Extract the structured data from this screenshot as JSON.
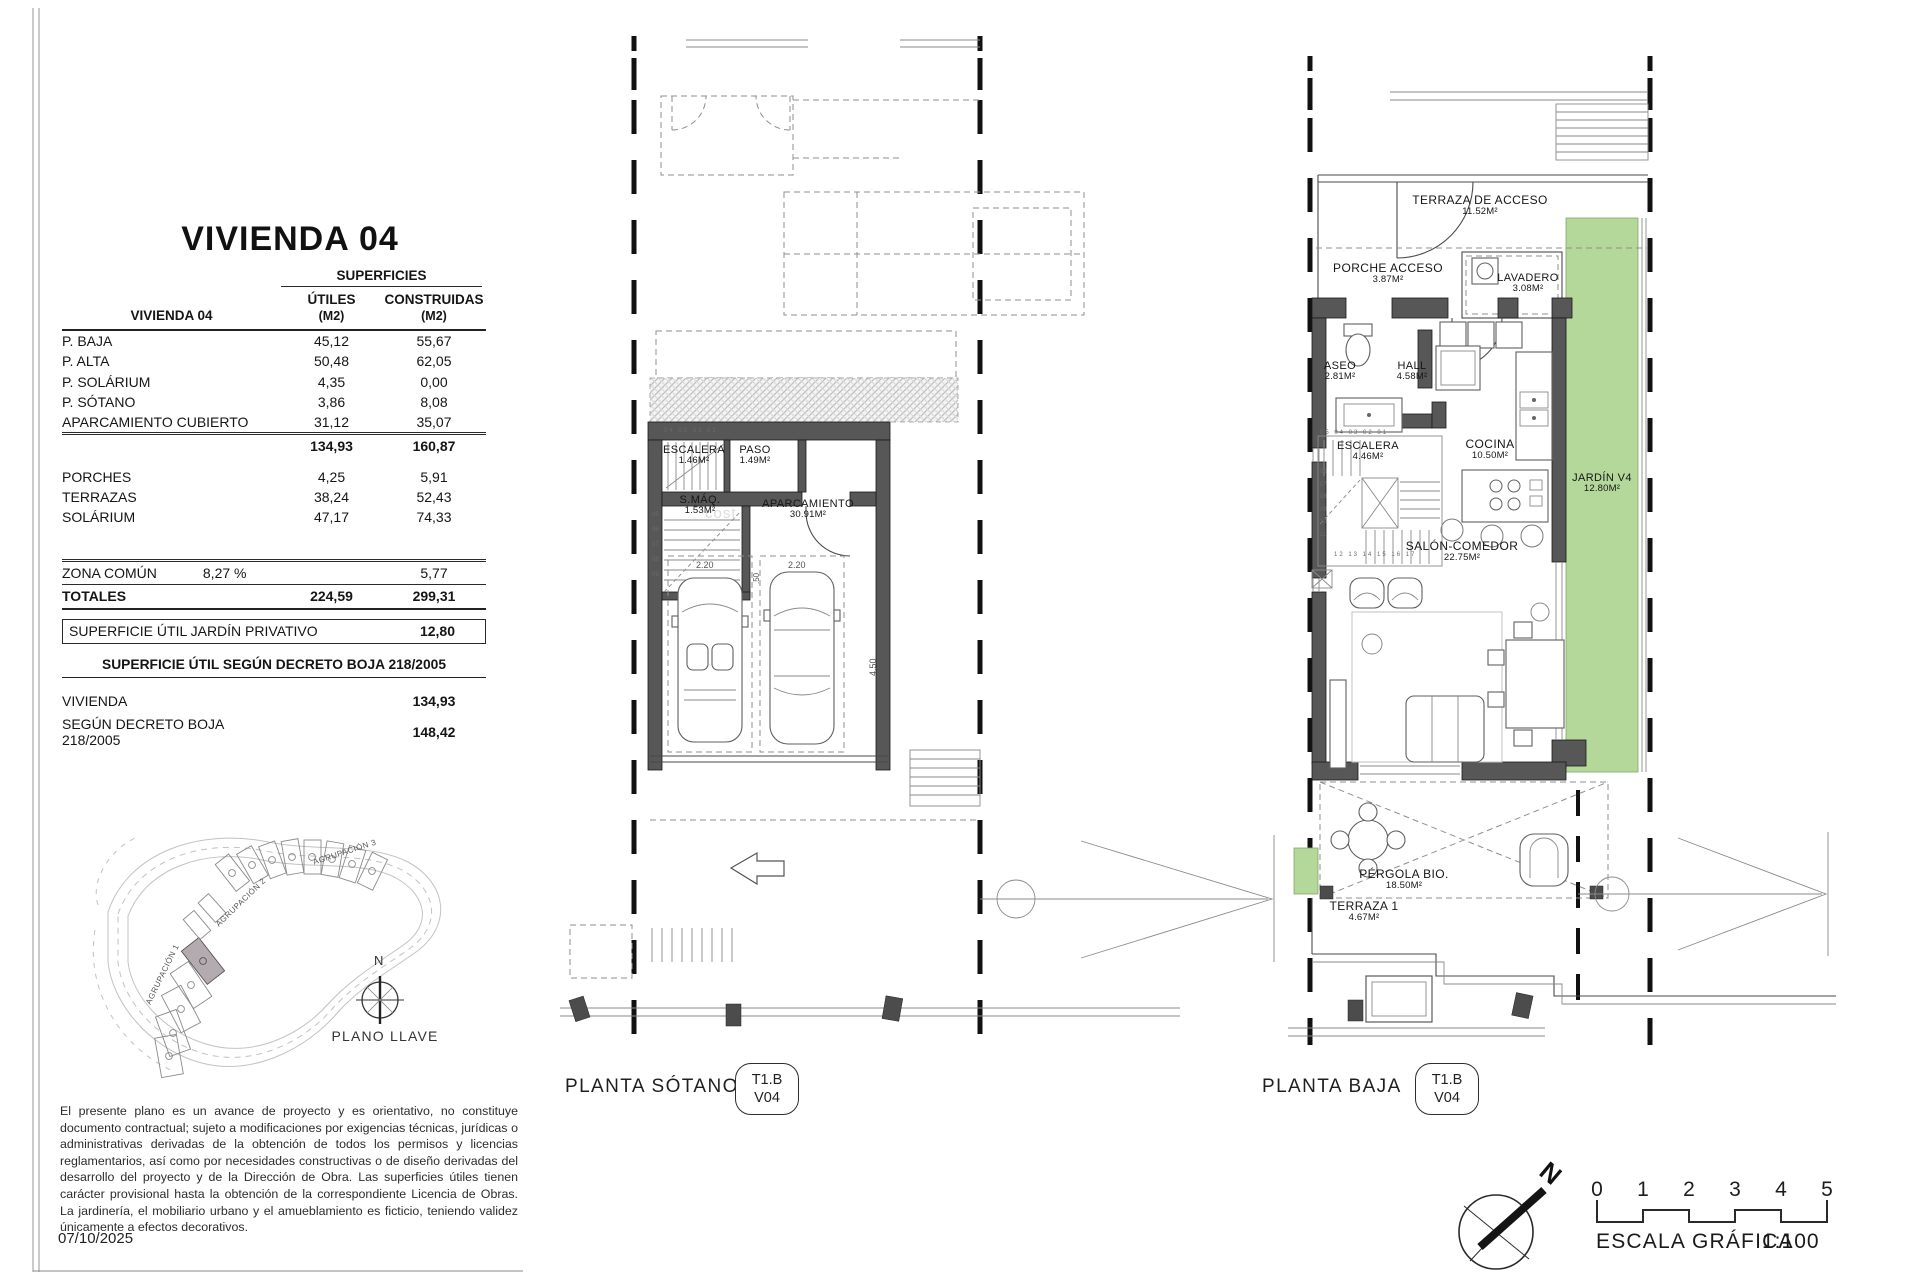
{
  "document": {
    "title": "VIVIENDA 04",
    "date": "07/10/2025",
    "watermark": "cost",
    "disclaimer": "El presente plano es un avance de proyecto y es orientativo, no constituye documento contractual; sujeto a modificaciones por exigencias técnicas, jurídicas o administrativas derivadas de la obtención de todos los permisos y licencias reglamentarios, así como por necesidades constructivas o de diseño derivadas del desarrollo del proyecto y de la Dirección de Obra. Las superficies útiles tienen carácter provisional hasta la obtención de la correspondiente Licencia de Obras. La jardinería, el mobiliario urbano y el amueblamiento es ficticio, teniendo validez únicamente a efectos decorativos."
  },
  "surface_table": {
    "group_header": "SUPERFICIES",
    "row_header": "VIVIENDA 04",
    "col1": "ÚTILES",
    "col2": "CONSTRUIDAS",
    "unit1": "(M2)",
    "unit2": "(M2)",
    "rows": [
      {
        "label": "P. BAJA",
        "utiles": "45,12",
        "construidas": "55,67"
      },
      {
        "label": "P. ALTA",
        "utiles": "50,48",
        "construidas": "62,05"
      },
      {
        "label": "P. SOLÁRIUM",
        "utiles": "4,35",
        "construidas": "0,00"
      },
      {
        "label": "P. SÓTANO",
        "utiles": "3,86",
        "construidas": "8,08"
      },
      {
        "label": "APARCAMIENTO CUBIERTO",
        "utiles": "31,12",
        "construidas": "35,07"
      }
    ],
    "subtotal": {
      "utiles": "134,93",
      "construidas": "160,87"
    },
    "rows2": [
      {
        "label": "PORCHES",
        "utiles": "4,25",
        "construidas": "5,91"
      },
      {
        "label": "TERRAZAS",
        "utiles": "38,24",
        "construidas": "52,43"
      },
      {
        "label": "SOLÁRIUM",
        "utiles": "47,17",
        "construidas": "74,33"
      }
    ],
    "zona_comun": {
      "label": "ZONA COMÚN",
      "pct": "8,27 %",
      "construidas": "5,77"
    },
    "totals": {
      "label": "TOTALES",
      "utiles": "224,59",
      "construidas": "299,31"
    },
    "jardin_privativo": {
      "label": "SUPERFICIE ÚTIL JARDÍN PRIVATIVO",
      "value": "12,80"
    },
    "decreto": {
      "header": "SUPERFICIE ÚTIL SEGÚN DECRETO BOJA 218/2005",
      "rows": [
        {
          "label": "VIVIENDA",
          "value": "134,93"
        },
        {
          "label": "SEGÚN DECRETO BOJA 218/2005",
          "value": "148,42"
        }
      ]
    }
  },
  "site_plan": {
    "caption": "PLANO LLAVE",
    "north": "N",
    "agrupacion1": "AGRUPACIÓN 1",
    "agrupacion2": "AGRUPACIÓN 2",
    "agrupacion3": "AGRUPACIÓN 3"
  },
  "plan_sotano": {
    "title": "PLANTA SÓTANO",
    "code_top": "T1.B",
    "code_bottom": "V04",
    "rooms": {
      "escalera": {
        "name": "ESCALERA",
        "area": "1.46M²"
      },
      "paso": {
        "name": "PASO",
        "area": "1.49M²"
      },
      "smaq": {
        "name": "S.MÁQ.",
        "area": "1.53M²"
      },
      "aparcamiento": {
        "name": "APARCAMIENTO",
        "area": "30.91M²"
      }
    },
    "dims": {
      "spot1": "2.20",
      "spot2": "2.20",
      "d50": ".50",
      "d450": "4.50"
    },
    "stair_top": "04      03  02  01",
    "stair_left": "05\n06\n07\n08\n09"
  },
  "plan_baja": {
    "title": "PLANTA BAJA",
    "code_top": "T1.B",
    "code_bottom": "V04",
    "rooms": {
      "terraza_acceso": {
        "name": "TERRAZA DE ACCESO",
        "area": "11.52M²"
      },
      "porche": {
        "name": "PORCHE ACCESO",
        "area": "3.87M²"
      },
      "lavadero": {
        "name": "LAVADERO",
        "area": "3.08M²"
      },
      "aseo": {
        "name": "ASEO",
        "area": "2.81M²"
      },
      "hall": {
        "name": "HALL",
        "area": "4.58M²"
      },
      "escalera": {
        "name": "ESCALERA",
        "area": "4.46M²"
      },
      "cocina": {
        "name": "COCINA",
        "area": "10.50M²"
      },
      "jardin": {
        "name": "JARDÍN V4",
        "area": "12.80M²"
      },
      "salon": {
        "name": "SALÓN-COMEDOR",
        "area": "22.75M²"
      },
      "pergola": {
        "name": "PÉRGOLA BIO.",
        "area": "18.50M²"
      },
      "terraza1": {
        "name": "TERRAZA 1",
        "area": "4.67M²"
      }
    },
    "stair_top": "05    04  03  02  01",
    "stair_left": "06\n07\n08\n09\n10\n11",
    "stair_bottom": "12  13  14  15  16  17"
  },
  "scale_bar": {
    "caption": "ESCALA GRÁFICA",
    "ratio": "1:100",
    "ticks": [
      "0",
      "1",
      "2",
      "3",
      "4",
      "5"
    ],
    "north": "N"
  },
  "colors": {
    "garden_green": "#b4d79a",
    "wall_gray": "#575757",
    "highlight_unit": "#b3abaf"
  }
}
